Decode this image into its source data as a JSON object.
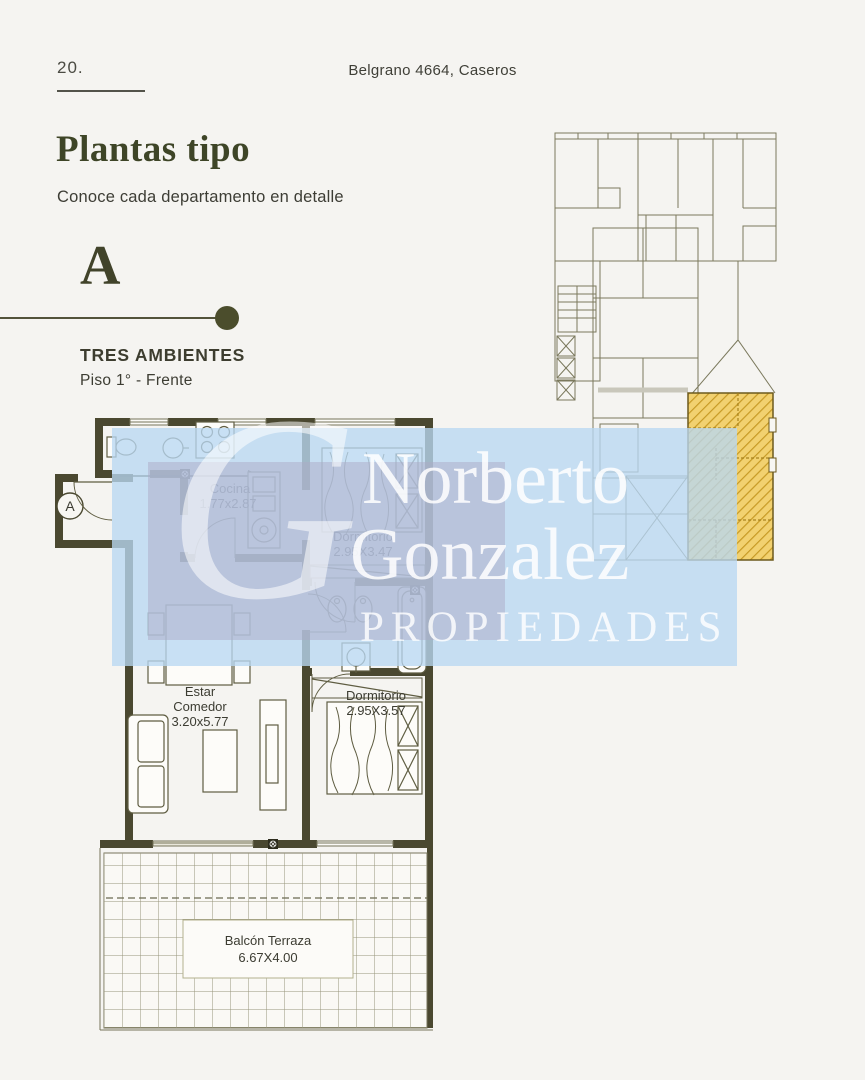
{
  "page": {
    "number": "20.",
    "address": "Belgrano 4664, Caseros"
  },
  "header": {
    "title": "Plantas tipo",
    "subtitle": "Conoce cada departamento en detalle"
  },
  "unit": {
    "letter": "A",
    "type_label": "TRES AMBIENTES",
    "floor_label": "Piso 1° - Frente"
  },
  "floorplan": {
    "entrance_label": "A",
    "rooms": {
      "cocina": {
        "name": "Cocina",
        "dims": "1.77x2.87"
      },
      "dormitorio1": {
        "name": "Dormitorio",
        "dims": "2.95X3.47"
      },
      "estar": {
        "name_line1": "Estar",
        "name_line2": "Comedor",
        "dims": "3.20x5.77"
      },
      "dormitorio2": {
        "name": "Dormitorio",
        "dims": "2.95X3.57"
      },
      "balcon": {
        "name": "Balcón Terraza",
        "dims": "6.67X4.00"
      }
    }
  },
  "watermark": {
    "monogram": "G",
    "line1": "Norberto",
    "line2": "Gonzalez",
    "line3": "PROPIEDADES"
  },
  "colors": {
    "background": "#f5f4f1",
    "wall": "#4a4830",
    "accent_olive": "#3e4527",
    "text": "#3d3d33",
    "keyplan_line": "#7b795d",
    "highlight_fill": "#f2d170",
    "highlight_stripe": "#c79a25",
    "watermark_blue": "#b9d7f2",
    "watermark_lavender": "#acA9c5"
  }
}
